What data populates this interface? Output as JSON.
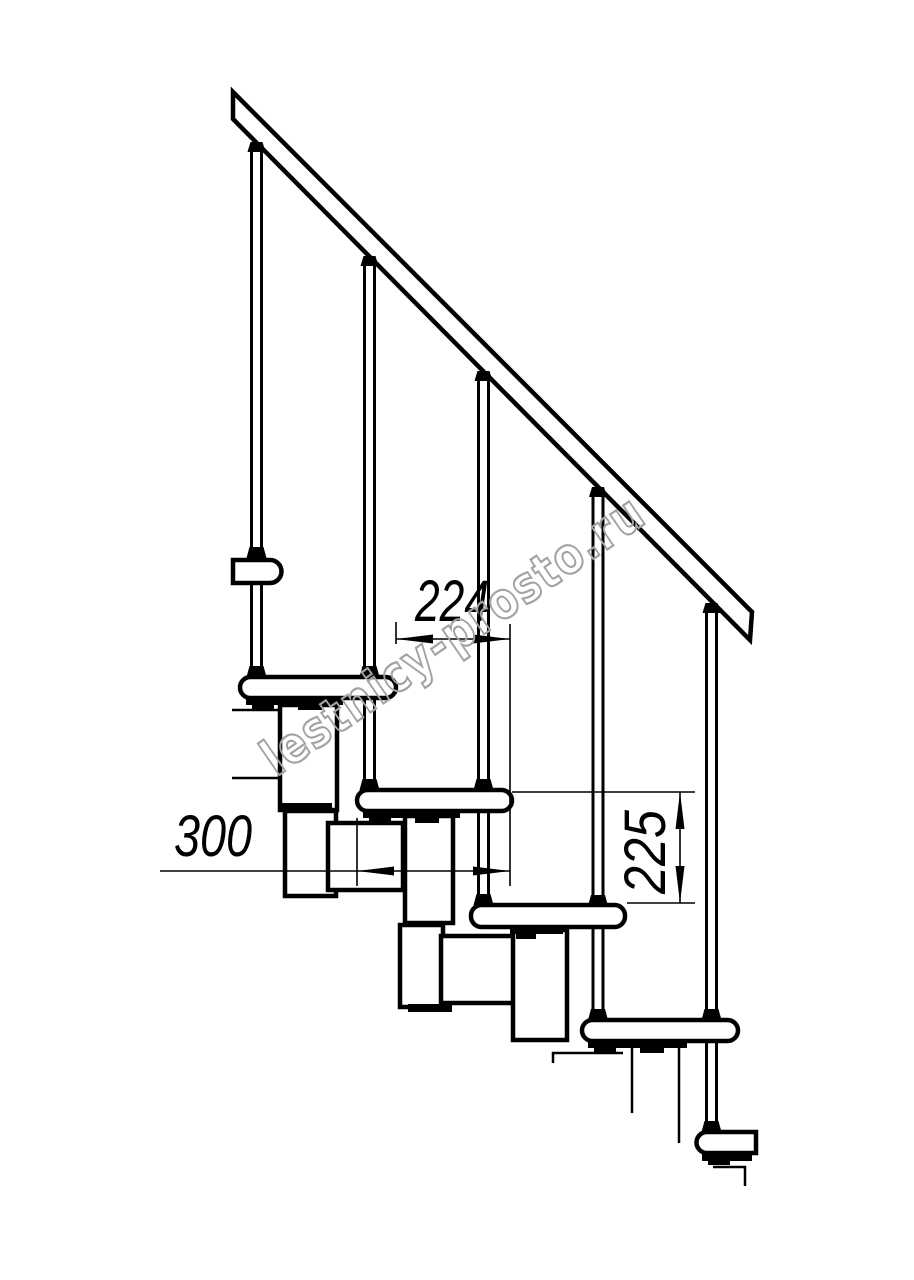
{
  "page": {
    "background_color": "#ffffff"
  },
  "drawing": {
    "line_color": "#000000",
    "dimensions": {
      "step_run_mm": "224",
      "tread_depth_mm": "300",
      "step_rise_mm": "225"
    },
    "watermark": {
      "text": "lestnicy-prosto.ru",
      "color": "#a2a2a2"
    },
    "structure": {
      "tread_count": 5,
      "baluster_count": 5,
      "has_handrail": true
    }
  }
}
